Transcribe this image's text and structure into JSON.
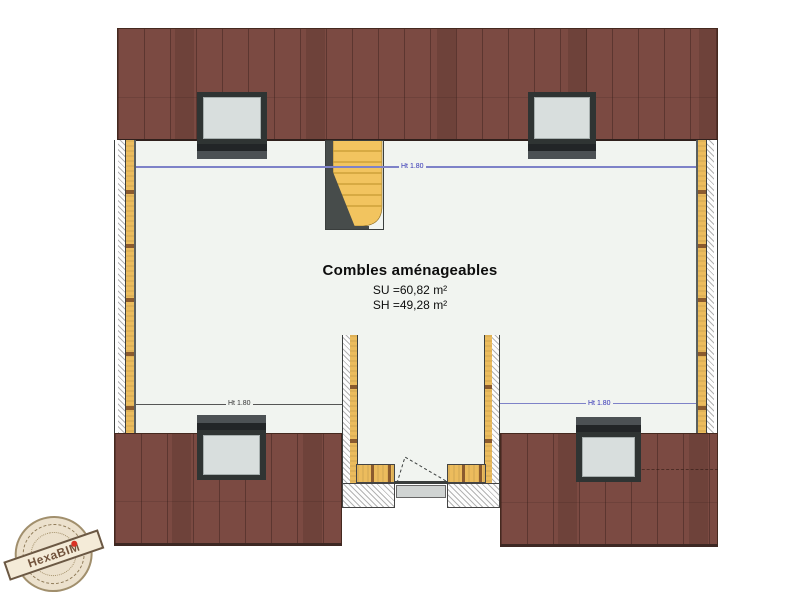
{
  "room": {
    "title": "Combles aménageables",
    "su": "SU =60,82 m²",
    "sh": "SH =49,28 m²"
  },
  "annotations": {
    "height_line_top": "Ht 1.80",
    "height_line_bottom_left": "Ht 1.80",
    "height_line_bottom_right": "Ht 1.80"
  },
  "watermark": {
    "brand": "HexaBIM"
  },
  "colors": {
    "roof": "#7b4a42",
    "insulation": "#ecbc5d",
    "window_glass": "#d8dedd",
    "window_frame": "#2f3433",
    "height_line_blue": "#7e82c8",
    "stairs": "#f2c45f",
    "stamp_paper": "#ebe0cb",
    "brand_red": "#d6281a",
    "floor": "#f1f4f0"
  }
}
